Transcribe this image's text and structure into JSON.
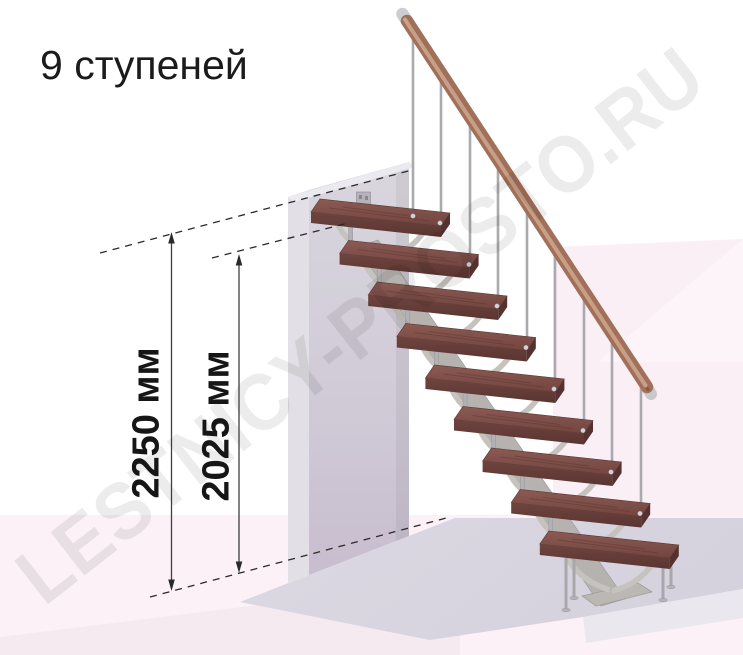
{
  "title": "9 ступеней",
  "watermark": "LESTNICY-PROSTO.RU",
  "stair": {
    "steps_count": 9,
    "description": "modular staircase with 9 wooden treads, central metal spine, balusters and wooden handrail"
  },
  "annotations": {
    "height_total_label": "2250 мм",
    "height_total_value": 2250,
    "height_to_top_step_label": "2025 мм",
    "height_to_top_step_value": 2025,
    "unit": "мм"
  },
  "colors": {
    "tread_wood": "#7d4f49",
    "tread_wood_dark": "#5c3733",
    "handrail_wood": "#a1705a",
    "metal": "#b5b2b0",
    "wall": "#d2ccd8",
    "floor_slab": "#dcd8e2",
    "background_pink_light": "#fcf2f8",
    "background_pink_mid": "#f9eef5",
    "background_pink_deep": "#f5e9f0",
    "annotation_line": "#3f3f44",
    "text": "#1b1b1b"
  }
}
